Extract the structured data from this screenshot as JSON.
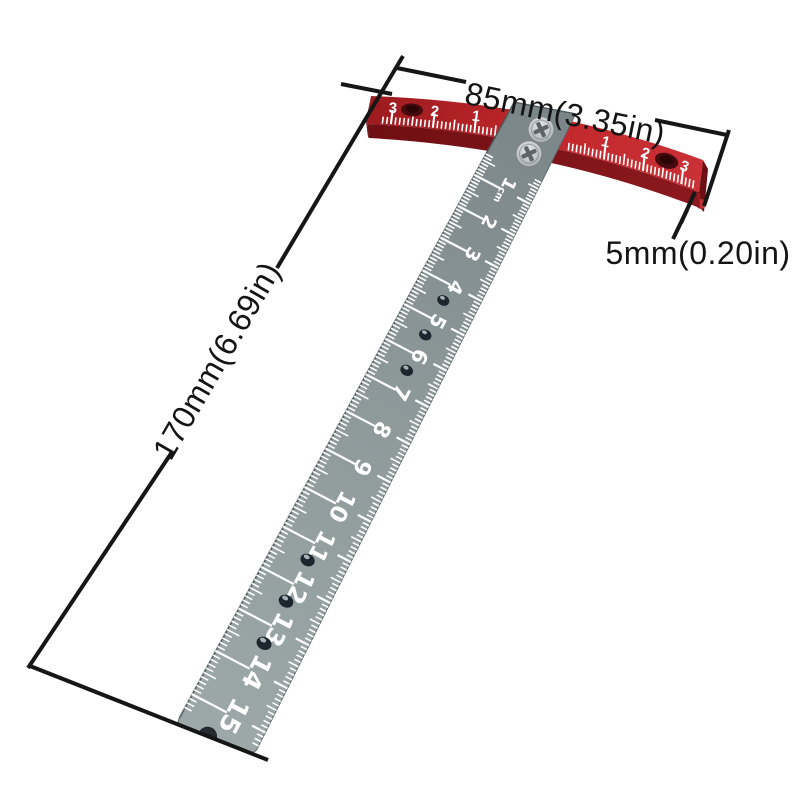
{
  "page": {
    "background": "#ffffff"
  },
  "annotations": {
    "width": {
      "label": "85mm(3.35in)"
    },
    "thickness": {
      "label": "5mm(0.20in)"
    },
    "length": {
      "label": "170mm(6.69in)"
    },
    "line_color": "#161616",
    "text_color": "#141414"
  },
  "head": {
    "left_numbers": [
      "3",
      "2",
      "1"
    ],
    "right_numbers": [
      "1",
      "2",
      "3"
    ],
    "colors": {
      "dark": "#9c1b1f",
      "main": "#c1272b",
      "bright": "#ca3136",
      "front": "#6f0f13",
      "front2": "#8c191d",
      "end": "#6e1013",
      "corner": "#bf3338",
      "hole": "#470a0e",
      "mark": "#ffffff"
    }
  },
  "blade": {
    "first_label": "1cm",
    "labels": [
      "1cm",
      "2",
      "3",
      "4",
      "5",
      "6",
      "7",
      "8",
      "9",
      "10",
      "11",
      "12",
      "13",
      "14",
      "15"
    ],
    "hole_positions_cm": [
      4.45,
      5.45,
      6.45,
      11.4,
      12.4,
      13.4
    ],
    "colors": {
      "top": "#7a8588",
      "mid": "#8d9899",
      "bottom": "#9da8a8",
      "mark": "#ffffff",
      "hole": "#1d262e",
      "notch": "#232b31"
    }
  },
  "screws": {
    "count": 2,
    "slot": "phillips"
  }
}
